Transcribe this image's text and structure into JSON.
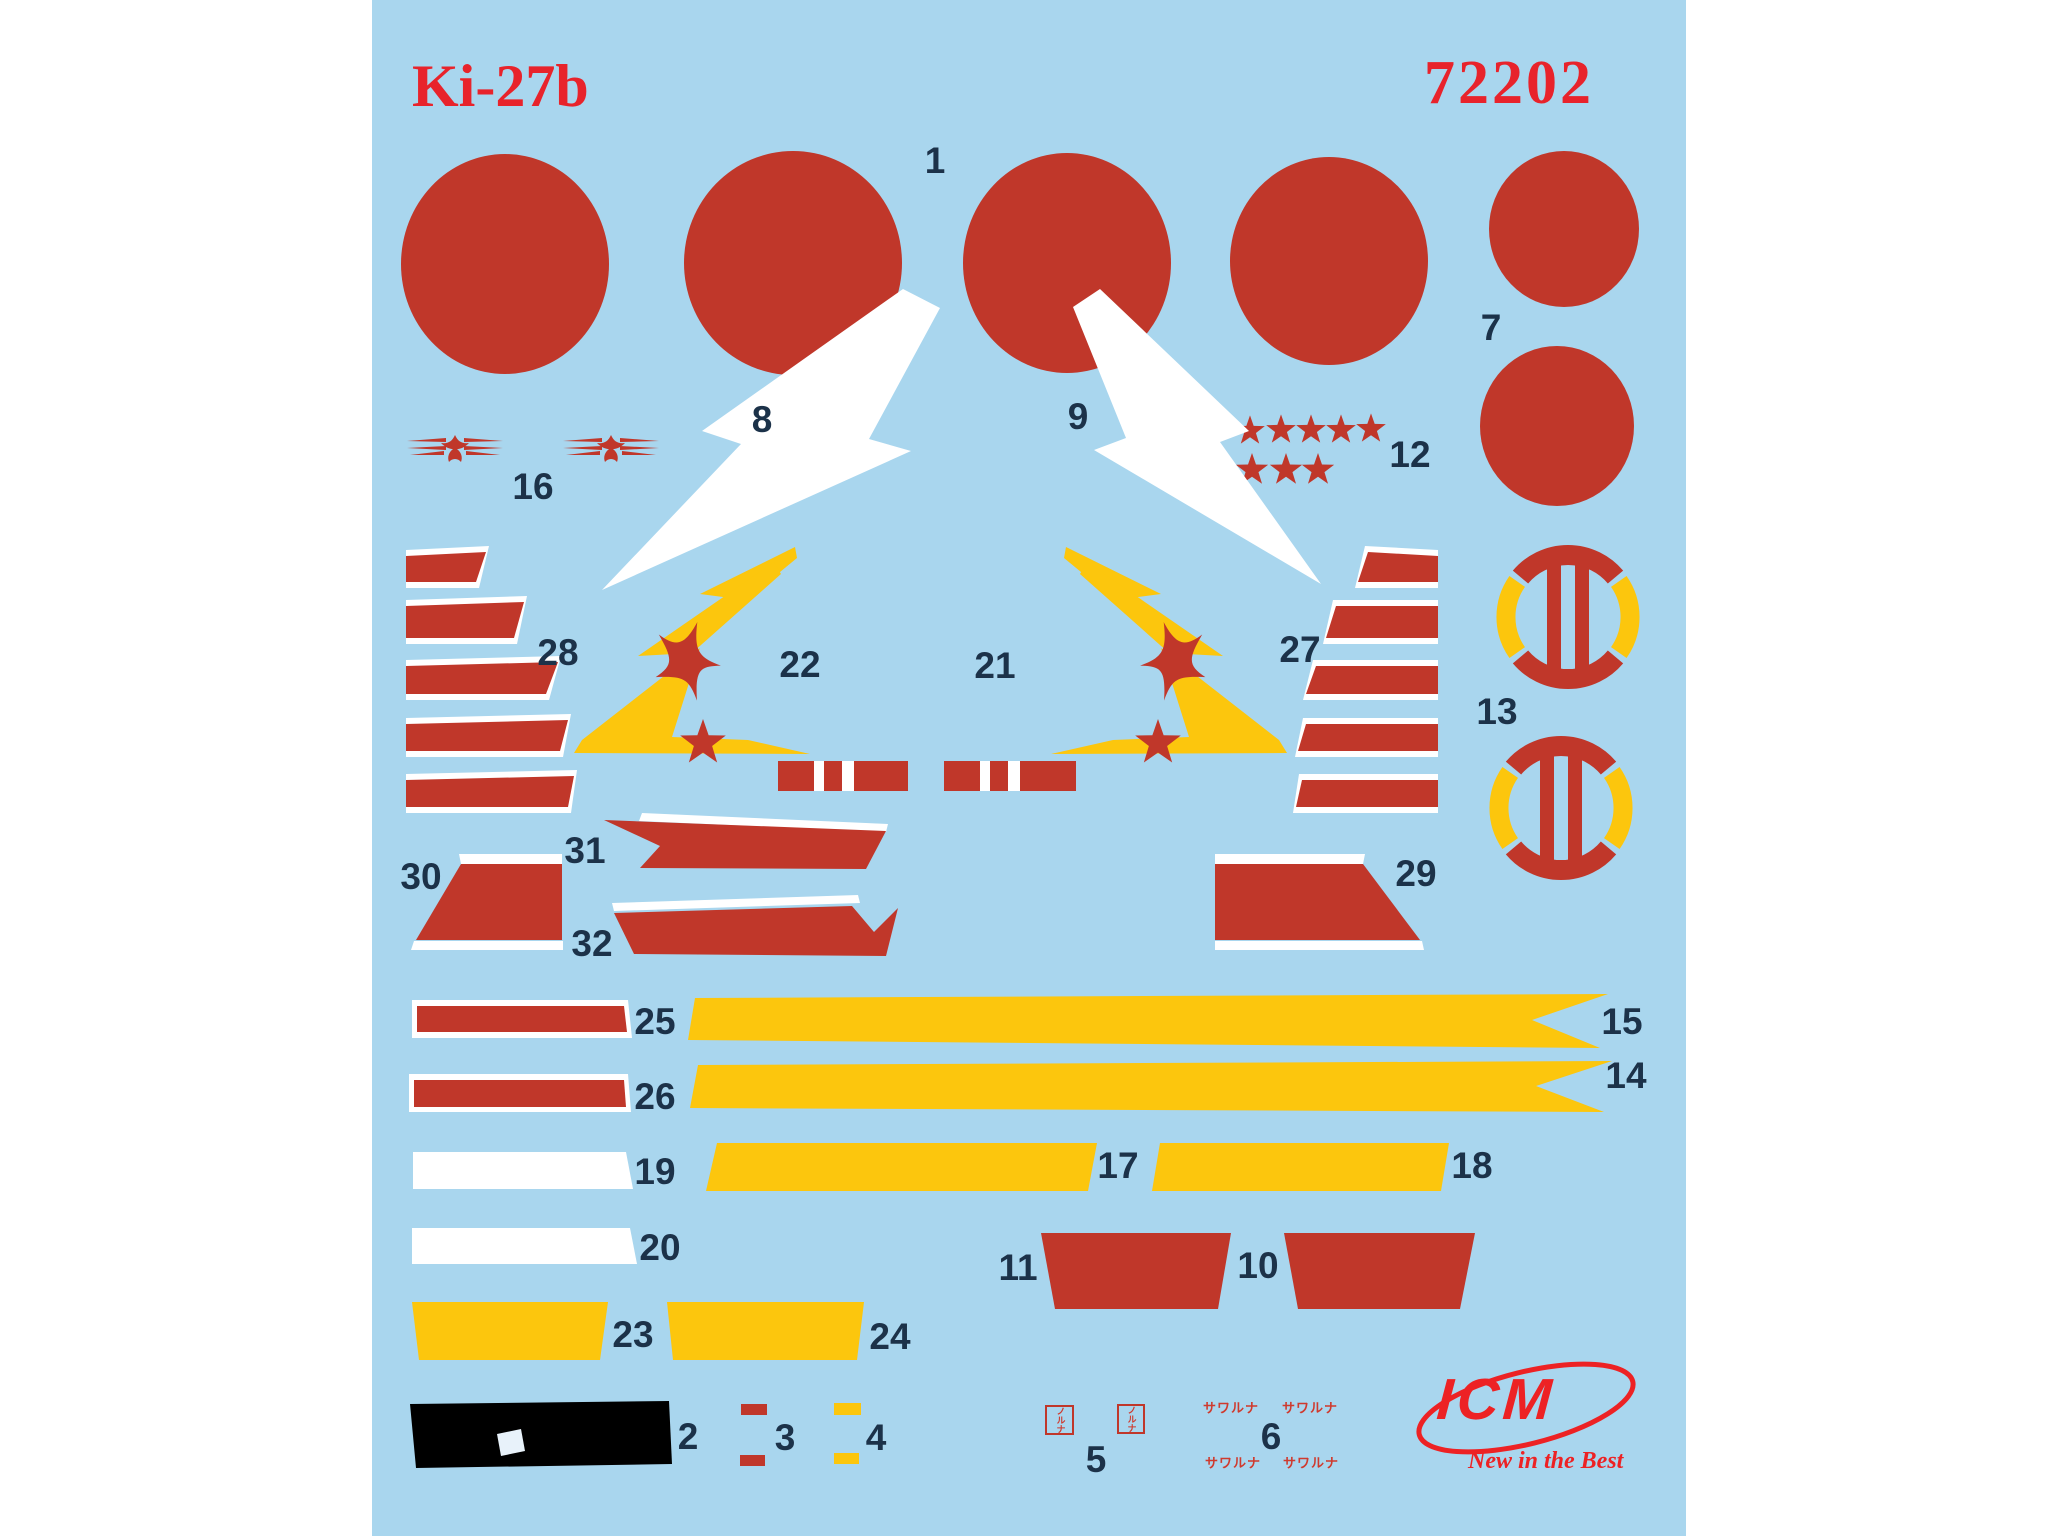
{
  "sheet": {
    "title": "Ki-27b",
    "product_code": "72202"
  },
  "labels": {
    "n1": "1",
    "n2": "2",
    "n3": "3",
    "n4": "4",
    "n5": "5",
    "n6": "6",
    "n7": "7",
    "n8": "8",
    "n9": "9",
    "n10": "10",
    "n11": "11",
    "n12": "12",
    "n13": "13",
    "n14": "14",
    "n15": "15",
    "n16": "16",
    "n17": "17",
    "n18": "18",
    "n19": "19",
    "n20": "20",
    "n21": "21",
    "n22": "22",
    "n23": "23",
    "n24": "24",
    "n25": "25",
    "n26": "26",
    "n27": "27",
    "n28": "28",
    "n29": "29",
    "n30": "30",
    "n31": "31",
    "n32": "32"
  },
  "stencils": {
    "caution_text": "サワルナ",
    "no_step_text": "ノルナ"
  },
  "logo": {
    "name": "ICM",
    "tagline": "New in the Best"
  },
  "colors": {
    "sheet_blue": "#a9d6ee",
    "decal_red": "#c0372a",
    "accent_red": "#e8232b",
    "decal_yellow": "#fcc60d",
    "label_navy": "#1c3249",
    "decal_black": "#000000",
    "decal_white": "#ffffff"
  }
}
